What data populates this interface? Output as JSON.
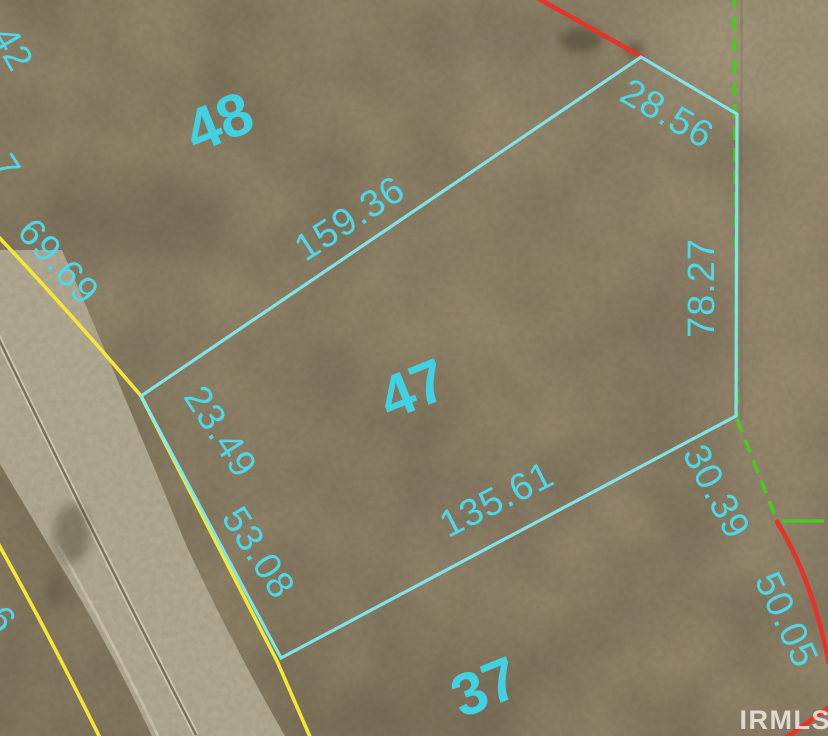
{
  "map": {
    "lots": [
      {
        "number": "48"
      },
      {
        "number": "47"
      },
      {
        "number": "37"
      }
    ],
    "parcel_dimensions": {
      "northwest_edge": "159.36",
      "northeast_edge": "28.56",
      "east_edge": "78.27",
      "south_edge": "135.61",
      "west_edge_upper": "23.49",
      "west_edge_lower": "53.08",
      "southeast_edge": "30.39",
      "southeast_far_edge": "50.05",
      "road_frontage_north": "69.69",
      "partial_edge_top_left": ".42",
      "partial_edge_mid_left": "7",
      "partial_edge_lower_left": "6"
    },
    "watermark": "IRMLS",
    "colors": {
      "parcel_highlight": "#7fe9ee",
      "label_text": "#4ed7e6",
      "lot_number_text": "#40d2e2",
      "right_of_way_yellow": "#f0e838",
      "boundary_red": "#e53427",
      "boundary_green": "#4ac823",
      "road_surface": "#b7af99",
      "ground_base": "#8b7e67",
      "watermark_text": "#ffffff"
    }
  }
}
